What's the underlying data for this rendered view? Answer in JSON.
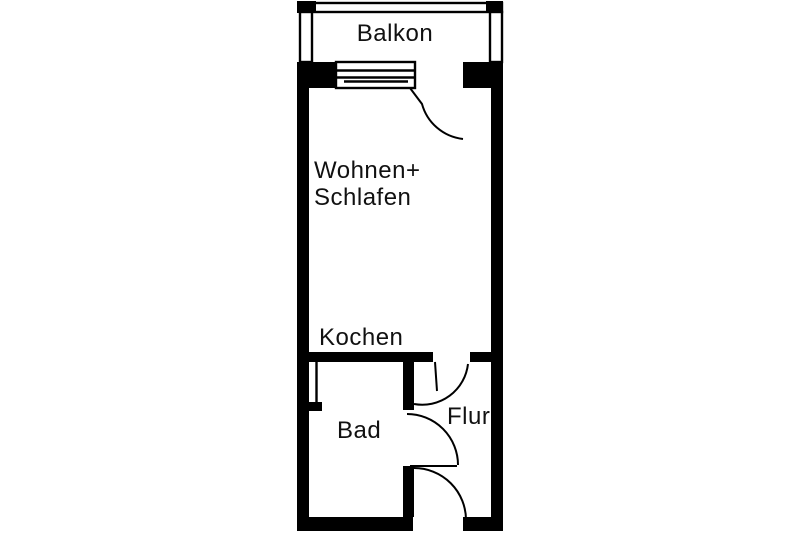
{
  "floorplan": {
    "background_color": "#ffffff",
    "wall_color": "#000000",
    "text_color": "#111111",
    "rooms": {
      "balcony": {
        "label": "Balkon"
      },
      "living_sleeping": {
        "label_line1": "Wohnen+",
        "label_line2": "Schlafen"
      },
      "kitchen": {
        "label": "Kochen"
      },
      "bathroom": {
        "label": "Bad"
      },
      "hallway": {
        "label": "Flur"
      }
    }
  }
}
